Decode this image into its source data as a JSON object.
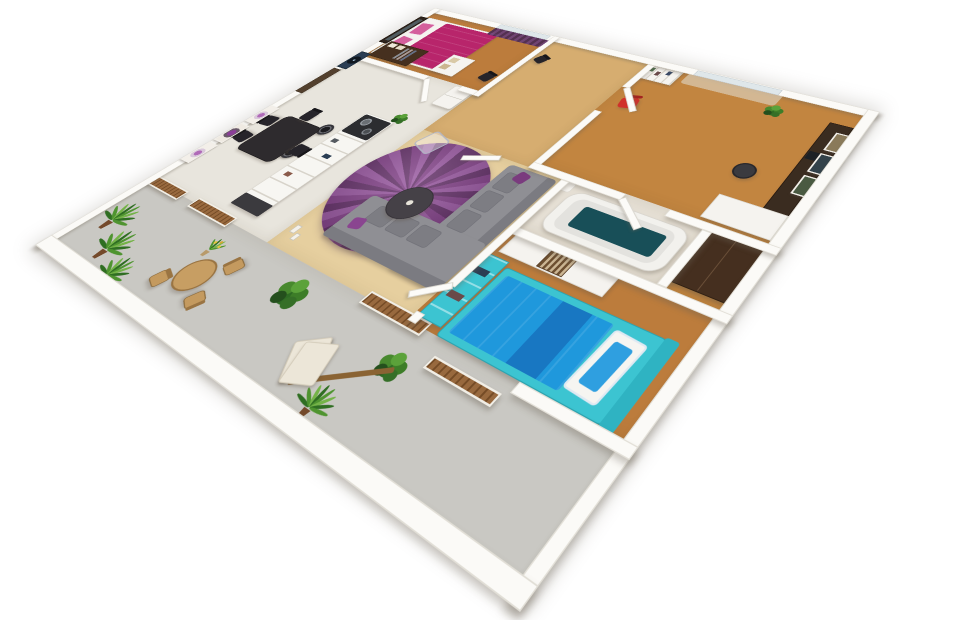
{
  "scene": {
    "type": "3d-apartment-floor-plan-render",
    "view": "isometric-perspective",
    "background": "#ffffff",
    "rooms": [
      {
        "name": "master-bedroom",
        "furniture": [
          "double-bed-magenta",
          "magenta-pillows",
          "wall-mirror",
          "wardrobe-open",
          "storage-cubby-boxes",
          "window-purple-curtain",
          "black-side-chair"
        ]
      },
      {
        "name": "entry-hall",
        "furniture": [
          "entry-door-brown",
          "fridge",
          "vinyl-record-wall-art",
          "black-hall-chair"
        ]
      },
      {
        "name": "kitchen-dining",
        "furniture": [
          "dining-table-dark",
          "dining-chairs-x4",
          "flower-wall-art-x3",
          "kitchen-island-shelves",
          "cooktop-with-pots",
          "bar-stools-x2",
          "island-end-cabinet",
          "island-plant"
        ]
      },
      {
        "name": "living-room",
        "furniture": [
          "purple-round-rug",
          "gray-sectional-sofa",
          "sofa-cushions",
          "purple-throw-pillows",
          "round-coffee-table",
          "acrylic-ghost-chair",
          "floor-candles"
        ]
      },
      {
        "name": "office",
        "furniture": [
          "tall-bookshelf",
          "window-sheer-curtain",
          "red-desk-chair",
          "dark-desk",
          "white-side-desk",
          "desk-chair-dark",
          "wall-posters-x3",
          "office-plant",
          "corner-closet"
        ]
      },
      {
        "name": "bathroom",
        "furniture": [
          "bathtub",
          "teal-bath-mat",
          "sink"
        ]
      },
      {
        "name": "bedroom-2",
        "furniture": [
          "single-bed-blue",
          "teal-bed-frame",
          "white-pillow",
          "tv-stand-white",
          "striped-storage-box",
          "turquoise-shelf-unit"
        ]
      },
      {
        "name": "terrace",
        "furniture": [
          "palm-plants-x3",
          "yellow-flower-plant",
          "round-outdoor-table",
          "outdoor-chairs-x3",
          "sun-lounger",
          "leafy-bushes",
          "wood-planter-walls-x4"
        ]
      }
    ]
  },
  "palette": {
    "wall": "#fbfaf7",
    "tile": "#e8e5dd",
    "terrace": "#c9c8c3",
    "woodwarm": "#bc7c3c",
    "woodhall": "#d6ad70",
    "woodlive": "#e6cf9f",
    "woodstrip": "#c28540",
    "bathfloor": "#e5dfd4",
    "magenta": "#b8256b",
    "pinkpillow": "#d45f9c",
    "blue": "#1f98dc",
    "bluedeep": "#1877c2",
    "teal": "#3cc4d1",
    "tealdark": "#184f58",
    "rug1": "#5e2a63",
    "rug2": "#7c3a82",
    "rug3": "#93519b",
    "red": "#d0312b",
    "sofa": "#8f8f94",
    "sofaback": "#7b7b81",
    "woodplanter": "#8f5c2e",
    "doorbrown": "#53402e",
    "navy": "#2b3e54",
    "dark": "#2e2b2e",
    "cream": "#ece6d8",
    "deskwood": "#3a2c20",
    "green1": "#2f6e22",
    "green2": "#4f9430",
    "green3": "#74b348",
    "potbrown": "#74492a"
  }
}
